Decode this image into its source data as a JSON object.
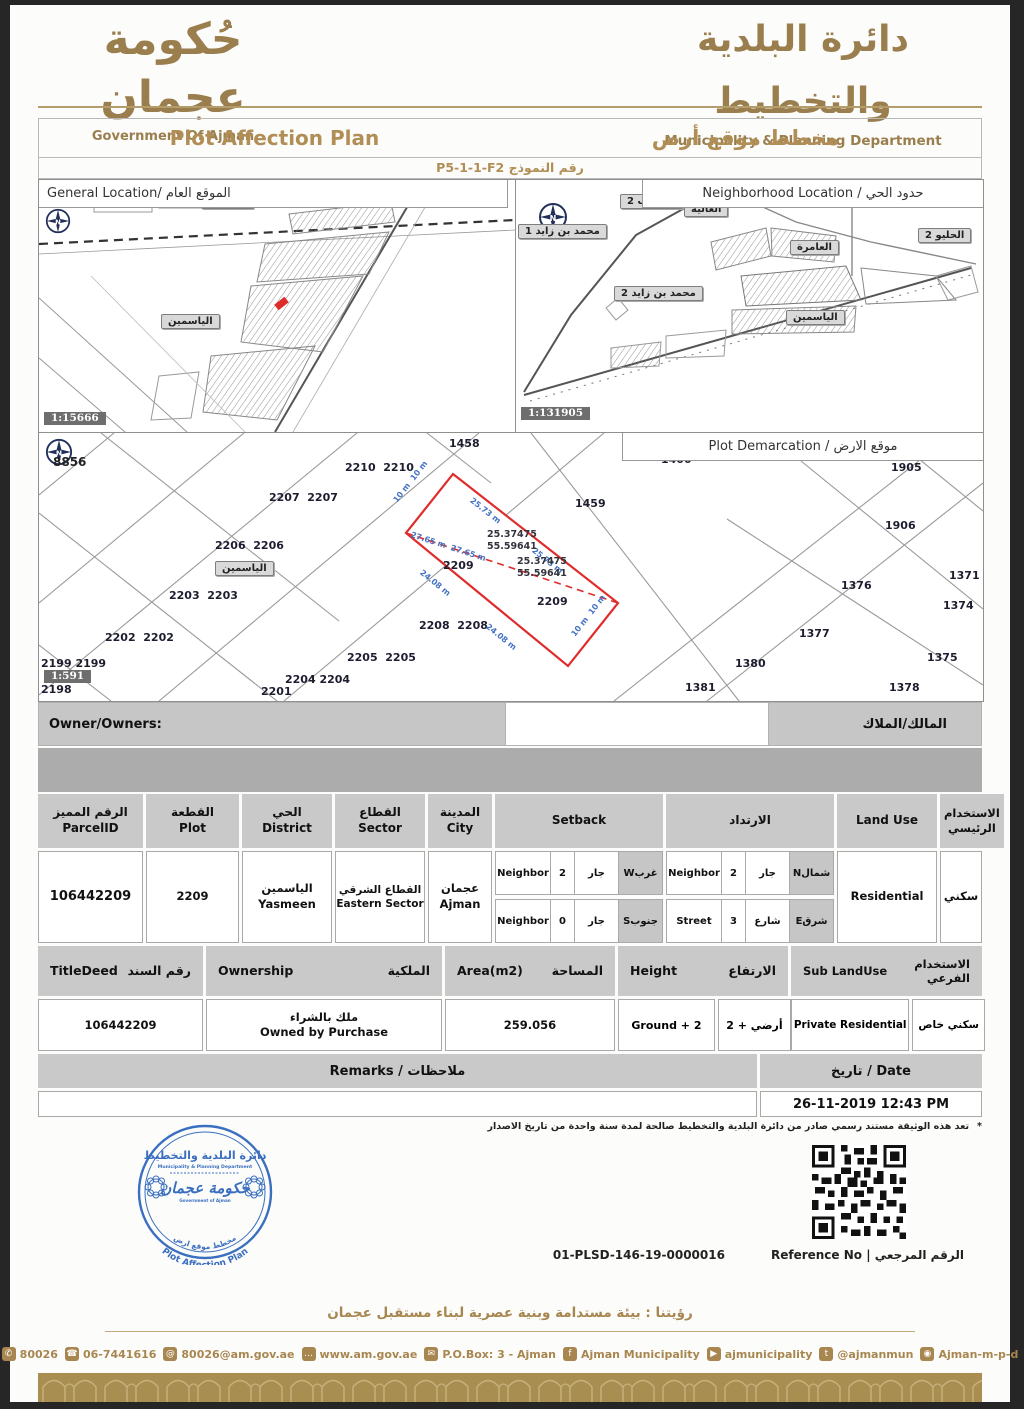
{
  "colors": {
    "gold": "#A8864F",
    "stamp_blue": "#3A6FC0",
    "plot_red": "#E02B2B",
    "dim_blue": "#4472C4"
  },
  "header": {
    "gov_ar": "حُكومة عجمان",
    "gov_en": "Government Of Ajman",
    "dept_ar": "دائرة البلدية والتخطيط",
    "dept_en": "Municipality & Planning Department"
  },
  "title_bar": {
    "en": "Plot Affection Plan",
    "ar": "مخطط موقع أرض"
  },
  "form_row": {
    "display": "رقم النموذج P5-1-1-F2"
  },
  "general_map": {
    "title": "General Location/ الموقع العام",
    "scale": "1:15666",
    "labels": [
      {
        "text": "الياسمين",
        "x": 122,
        "y": 134,
        "cls": "maplabel",
        "name": "district-label-yasmeen"
      },
      {
        "text": "الحليو 2",
        "x": 162,
        "y": 14,
        "cls": "maplabel",
        "name": "district-label-helio2-partial"
      }
    ]
  },
  "neighborhood_map": {
    "title": "Neighborhood Location / حدود الحي",
    "scale": "1:131905",
    "labels": [
      {
        "text": "الرقايب 2",
        "x": 104,
        "y": 14,
        "cls": "maplabel",
        "name": "district-label-raqaib2"
      },
      {
        "text": "العالية",
        "x": 168,
        "y": 22,
        "cls": "maplabel",
        "name": "district-label-alia"
      },
      {
        "text": "العامرة",
        "x": 274,
        "y": 60,
        "cls": "maplabel",
        "name": "district-label-amerah"
      },
      {
        "text": "الحليو 2",
        "x": 402,
        "y": 48,
        "cls": "maplabel",
        "name": "district-label-helio2"
      },
      {
        "text": "محمد بن زايد 1",
        "x": 2,
        "y": 44,
        "cls": "maplabel",
        "name": "district-label-mbz1"
      },
      {
        "text": "محمد بن زايد 2",
        "x": 98,
        "y": 106,
        "cls": "maplabel",
        "name": "district-label-mbz2"
      },
      {
        "text": "الياسمين",
        "x": 270,
        "y": 130,
        "cls": "maplabel",
        "name": "district-label-yasmeen"
      }
    ]
  },
  "demarcation_map": {
    "title": "Plot Demarcation / موقع الارض",
    "scale": "1:591",
    "compass_no": "8856",
    "yasmeen_label": "الياسمين",
    "plot_labels": [
      {
        "text": "1458",
        "x": 410,
        "y": 4,
        "cls": "plotnum",
        "name": "plot-1458"
      },
      {
        "text": "1400",
        "x": 622,
        "y": 20,
        "cls": "plotnum",
        "name": "plot-1400"
      },
      {
        "text": "2210  2210",
        "x": 306,
        "y": 28,
        "cls": "plotnum",
        "name": "plot-2210"
      },
      {
        "text": "2207  2207",
        "x": 230,
        "y": 58,
        "cls": "plotnum",
        "name": "plot-2207"
      },
      {
        "text": "2206  2206",
        "x": 176,
        "y": 106,
        "cls": "plotnum",
        "name": "plot-2206"
      },
      {
        "text": "2203  2203",
        "x": 130,
        "y": 156,
        "cls": "plotnum",
        "name": "plot-2203"
      },
      {
        "text": "2202  2202",
        "x": 66,
        "y": 198,
        "cls": "plotnum",
        "name": "plot-2202"
      },
      {
        "text": "2199 2199",
        "x": 2,
        "y": 224,
        "cls": "plotnum",
        "name": "plot-2199"
      },
      {
        "text": "2198",
        "x": 2,
        "y": 250,
        "cls": "plotnum",
        "name": "plot-2198"
      },
      {
        "text": "2201",
        "x": 222,
        "y": 252,
        "cls": "plotnum",
        "name": "plot-2201"
      },
      {
        "text": "2204 2204",
        "x": 246,
        "y": 240,
        "cls": "plotnum",
        "name": "plot-2204"
      },
      {
        "text": "2205  2205",
        "x": 308,
        "y": 218,
        "cls": "plotnum",
        "name": "plot-2205"
      },
      {
        "text": "2208  2208",
        "x": 380,
        "y": 186,
        "cls": "plotnum",
        "name": "plot-2208"
      },
      {
        "text": "2209",
        "x": 404,
        "y": 126,
        "cls": "plotnum",
        "name": "plot-2209"
      },
      {
        "text": "2209",
        "x": 498,
        "y": 162,
        "cls": "plotnum",
        "name": "plot-2209"
      },
      {
        "text": "1459",
        "x": 536,
        "y": 64,
        "cls": "plotnum",
        "name": "plot-1459"
      },
      {
        "text": "1905",
        "x": 852,
        "y": 28,
        "cls": "plotnum",
        "name": "plot-1905"
      },
      {
        "text": "1906",
        "x": 846,
        "y": 86,
        "cls": "plotnum",
        "name": "plot-1906"
      },
      {
        "text": "1371",
        "x": 910,
        "y": 136,
        "cls": "plotnum",
        "name": "plot-1371"
      },
      {
        "text": "1376",
        "x": 802,
        "y": 146,
        "cls": "plotnum",
        "name": "plot-1376"
      },
      {
        "text": "1374",
        "x": 904,
        "y": 166,
        "cls": "plotnum",
        "name": "plot-1374"
      },
      {
        "text": "1377",
        "x": 760,
        "y": 194,
        "cls": "plotnum",
        "name": "plot-1377"
      },
      {
        "text": "1375",
        "x": 888,
        "y": 218,
        "cls": "plotnum",
        "name": "plot-1375"
      },
      {
        "text": "1380",
        "x": 696,
        "y": 224,
        "cls": "plotnum",
        "name": "plot-1380"
      },
      {
        "text": "1381",
        "x": 646,
        "y": 248,
        "cls": "plotnum",
        "name": "plot-1381"
      },
      {
        "text": "1378",
        "x": 850,
        "y": 248,
        "cls": "plotnum",
        "name": "plot-1378"
      }
    ],
    "dimensions": [
      {
        "text": "10 m  10 m",
        "x": 356,
        "y": 64,
        "rot": -52,
        "cls": "dim",
        "name": "dim-10m-top"
      },
      {
        "text": "25.73 m",
        "x": 432,
        "y": 62,
        "rot": 38,
        "cls": "dim",
        "name": "dim-25-73m"
      },
      {
        "text": "25.73 m",
        "x": 494,
        "y": 112,
        "rot": 38,
        "cls": "dim",
        "name": "dim-25-73m"
      },
      {
        "text": "27.65 m  27.65 m",
        "x": 372,
        "y": 97,
        "rot": 18,
        "cls": "dim",
        "name": "dim-27-65m"
      },
      {
        "text": "24.08 m",
        "x": 382,
        "y": 134,
        "rot": 39,
        "cls": "dim",
        "name": "dim-24-08m"
      },
      {
        "text": "24.08 m",
        "x": 448,
        "y": 188,
        "rot": 39,
        "cls": "dim",
        "name": "dim-24-08m"
      },
      {
        "text": "10 m  10 m",
        "x": 534,
        "y": 198,
        "rot": -52,
        "cls": "dim",
        "name": "dim-10m-bottom"
      }
    ],
    "coordinates": [
      {
        "text": "25.37475",
        "x": 448,
        "y": 96,
        "cls": "coordtxt",
        "name": "coordinate-lat"
      },
      {
        "text": "55.59641",
        "x": 448,
        "y": 108,
        "cls": "coordtxt",
        "name": "coordinate-lon"
      },
      {
        "text": "25.37475",
        "x": 478,
        "y": 123,
        "cls": "coordtxt",
        "name": "coordinate-lat"
      },
      {
        "text": "55.59641",
        "x": 478,
        "y": 135,
        "cls": "coordtxt",
        "name": "coordinate-lon"
      }
    ]
  },
  "owner_row": {
    "en": "Owner/Owners:",
    "ar": "المالك/الملاك"
  },
  "table1": {
    "headers": {
      "parcel_ar": "الرقم المميز",
      "parcel_en": "ParcelID",
      "plot_ar": "القطعة",
      "plot_en": "Plot",
      "district_ar": "الحي",
      "district_en": "District",
      "sector_ar": "القطاع",
      "sector_en": "Sector",
      "city_ar": "المدينة",
      "city_en": "City",
      "setback_en": "Setback",
      "setback_ar": "الارتداد",
      "land_use": "Land Use",
      "main_use_ar": "الاستخدام الرئيسي"
    },
    "row": {
      "parcel_id": "106442209",
      "plot": "2209",
      "district_ar": "الياسمين",
      "district_en": "Yasmeen",
      "sector_ar": "القطاع الشرقي",
      "sector_en": "Eastern Sector",
      "city_ar": "عجمان",
      "city_en": "Ajman",
      "setback_w": {
        "type": "Neighbor",
        "value": "2",
        "type_ar": "جار",
        "dir": "غربW"
      },
      "setback_s": {
        "type": "Neighbor",
        "value": "0",
        "type_ar": "جار",
        "dir": "جنوبS"
      },
      "setback_n": {
        "type": "Neighbor",
        "value": "2",
        "type_ar": "جار",
        "dir": "شمالN"
      },
      "setback_e": {
        "type": "Street",
        "value": "3",
        "type_ar": "شارع",
        "dir": "شرقE"
      },
      "land_use": "Residential",
      "main_use_ar": "سكني"
    }
  },
  "table2": {
    "headers": {
      "titledeed_en": "TitleDeed",
      "titledeed_ar": "رقم السند",
      "ownership_en": "Ownership",
      "ownership_ar": "الملكية",
      "area_en": "Area(m2)",
      "area_ar": "المساحة",
      "height_en": "Height",
      "height_ar": "الارتفاع",
      "sub_en": "Sub LandUse",
      "sub_ar": "الاستخدام الفرعي"
    },
    "row": {
      "title_deed": "106442209",
      "ownership_ar": "ملك بالشراء",
      "ownership_en": "Owned by Purchase",
      "area": "259.056",
      "height_en": "Ground + 2",
      "height_ar": "أرضي + 2",
      "sub_en": "Private Residential",
      "sub_ar": "سكني خاص"
    }
  },
  "remarks": {
    "header": "Remarks / ملاحظات",
    "date_header": "تاريخ / Date",
    "date_value": "26-11-2019 12:43 PM"
  },
  "disclaimer": {
    "text": "تعد هذه الوثيقة مستند رسمي صادر من دائرة البلدية والتخطيط صالحة لمدة سنة واحدة من تاريخ الاصدار",
    "bullet": "*"
  },
  "stamp": {
    "dept_ar": "دائرة البلدية والتخطيط",
    "dept_en": "Municipality & Planning Department",
    "gov_ar": "حكومة عجمان",
    "gov_en": "Government of Ajman",
    "arc_ar": "مخطط موقع ارض",
    "arc_en": "Plot Affection Plan"
  },
  "reference": {
    "value": "01-PLSD-146-19-0000016",
    "label": "Reference No | الرقم المرجعي"
  },
  "footer": {
    "vision": "رؤيتنا : بيئة مستدامة وبنية عصرية لبناء مستقبل عجمان",
    "contacts": [
      {
        "icon": "phone-icon",
        "glyph": "✆",
        "text": "80026"
      },
      {
        "icon": "fax-icon",
        "glyph": "☎",
        "text": "06-7441616"
      },
      {
        "icon": "email-icon",
        "glyph": "@",
        "text": "80026@am.gov.ae"
      },
      {
        "icon": "website-icon",
        "glyph": "…",
        "text": "www.am.gov.ae"
      },
      {
        "icon": "pobox-icon",
        "glyph": "✉",
        "text": "P.O.Box: 3 - Ajman"
      },
      {
        "icon": "facebook-icon",
        "glyph": "f",
        "text": "Ajman Municipality"
      },
      {
        "icon": "youtube-icon",
        "glyph": "▶",
        "text": "ajmunicipality"
      },
      {
        "icon": "twitter-icon",
        "glyph": "t",
        "text": "@ajmanmun"
      },
      {
        "icon": "instagram-icon",
        "glyph": "◉",
        "text": "Ajman-m-p-d"
      }
    ]
  }
}
